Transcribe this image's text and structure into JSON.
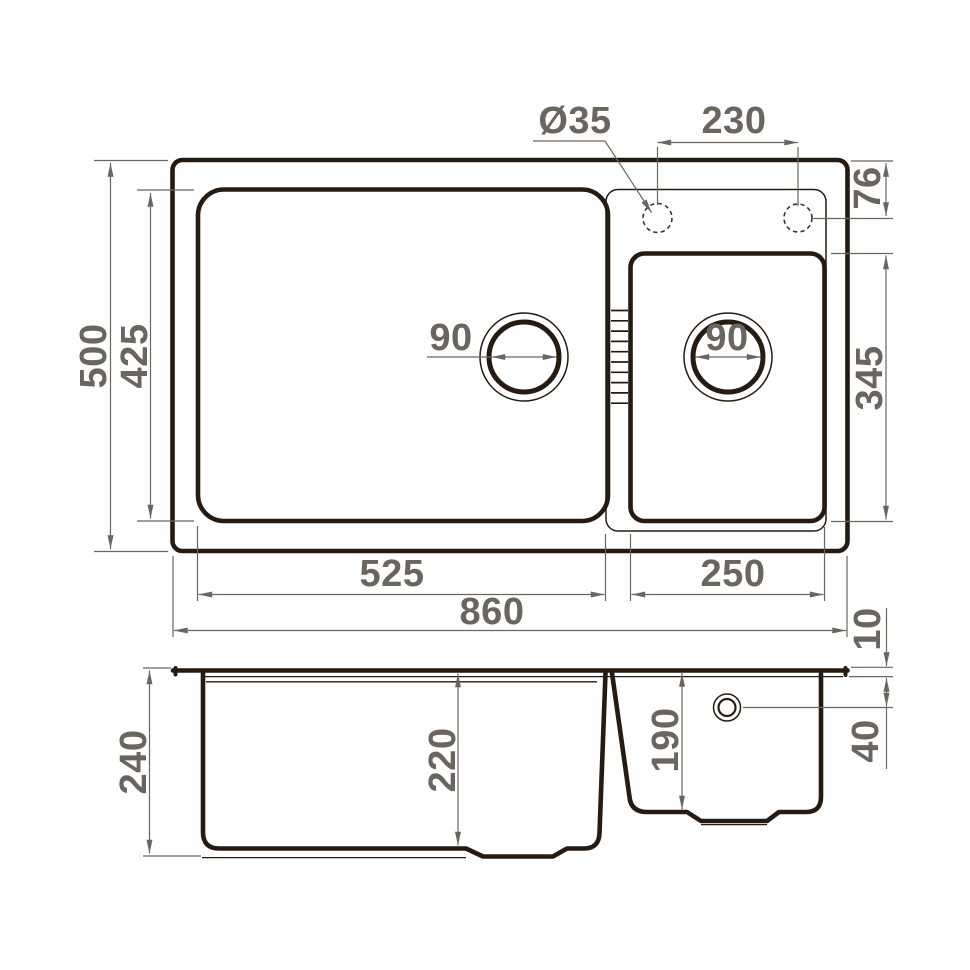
{
  "title": "Double-bowl kitchen sink dimensional drawing",
  "colors": {
    "line": "#251b11",
    "dim": "#6b655f",
    "dash": "#3b322a",
    "bg": "#ffffff"
  },
  "views": {
    "top": {
      "dims": {
        "overall_width": "860",
        "overall_depth": "500",
        "main_bowl_width": "525",
        "main_bowl_depth": "425",
        "second_bowl_width": "250",
        "second_bowl_depth": "345",
        "faucet_hole_diameter": "Ø35",
        "faucet_hole_spacing": "230",
        "faucet_edge_offset": "76",
        "main_drain_diameter": "90",
        "second_drain_diameter": "90"
      }
    },
    "section": {
      "dims": {
        "total_height": "240",
        "main_bowl_inner_depth": "220",
        "second_bowl_inner_depth": "190",
        "rim_lip_height": "10",
        "overflow_offset": "40"
      }
    }
  }
}
